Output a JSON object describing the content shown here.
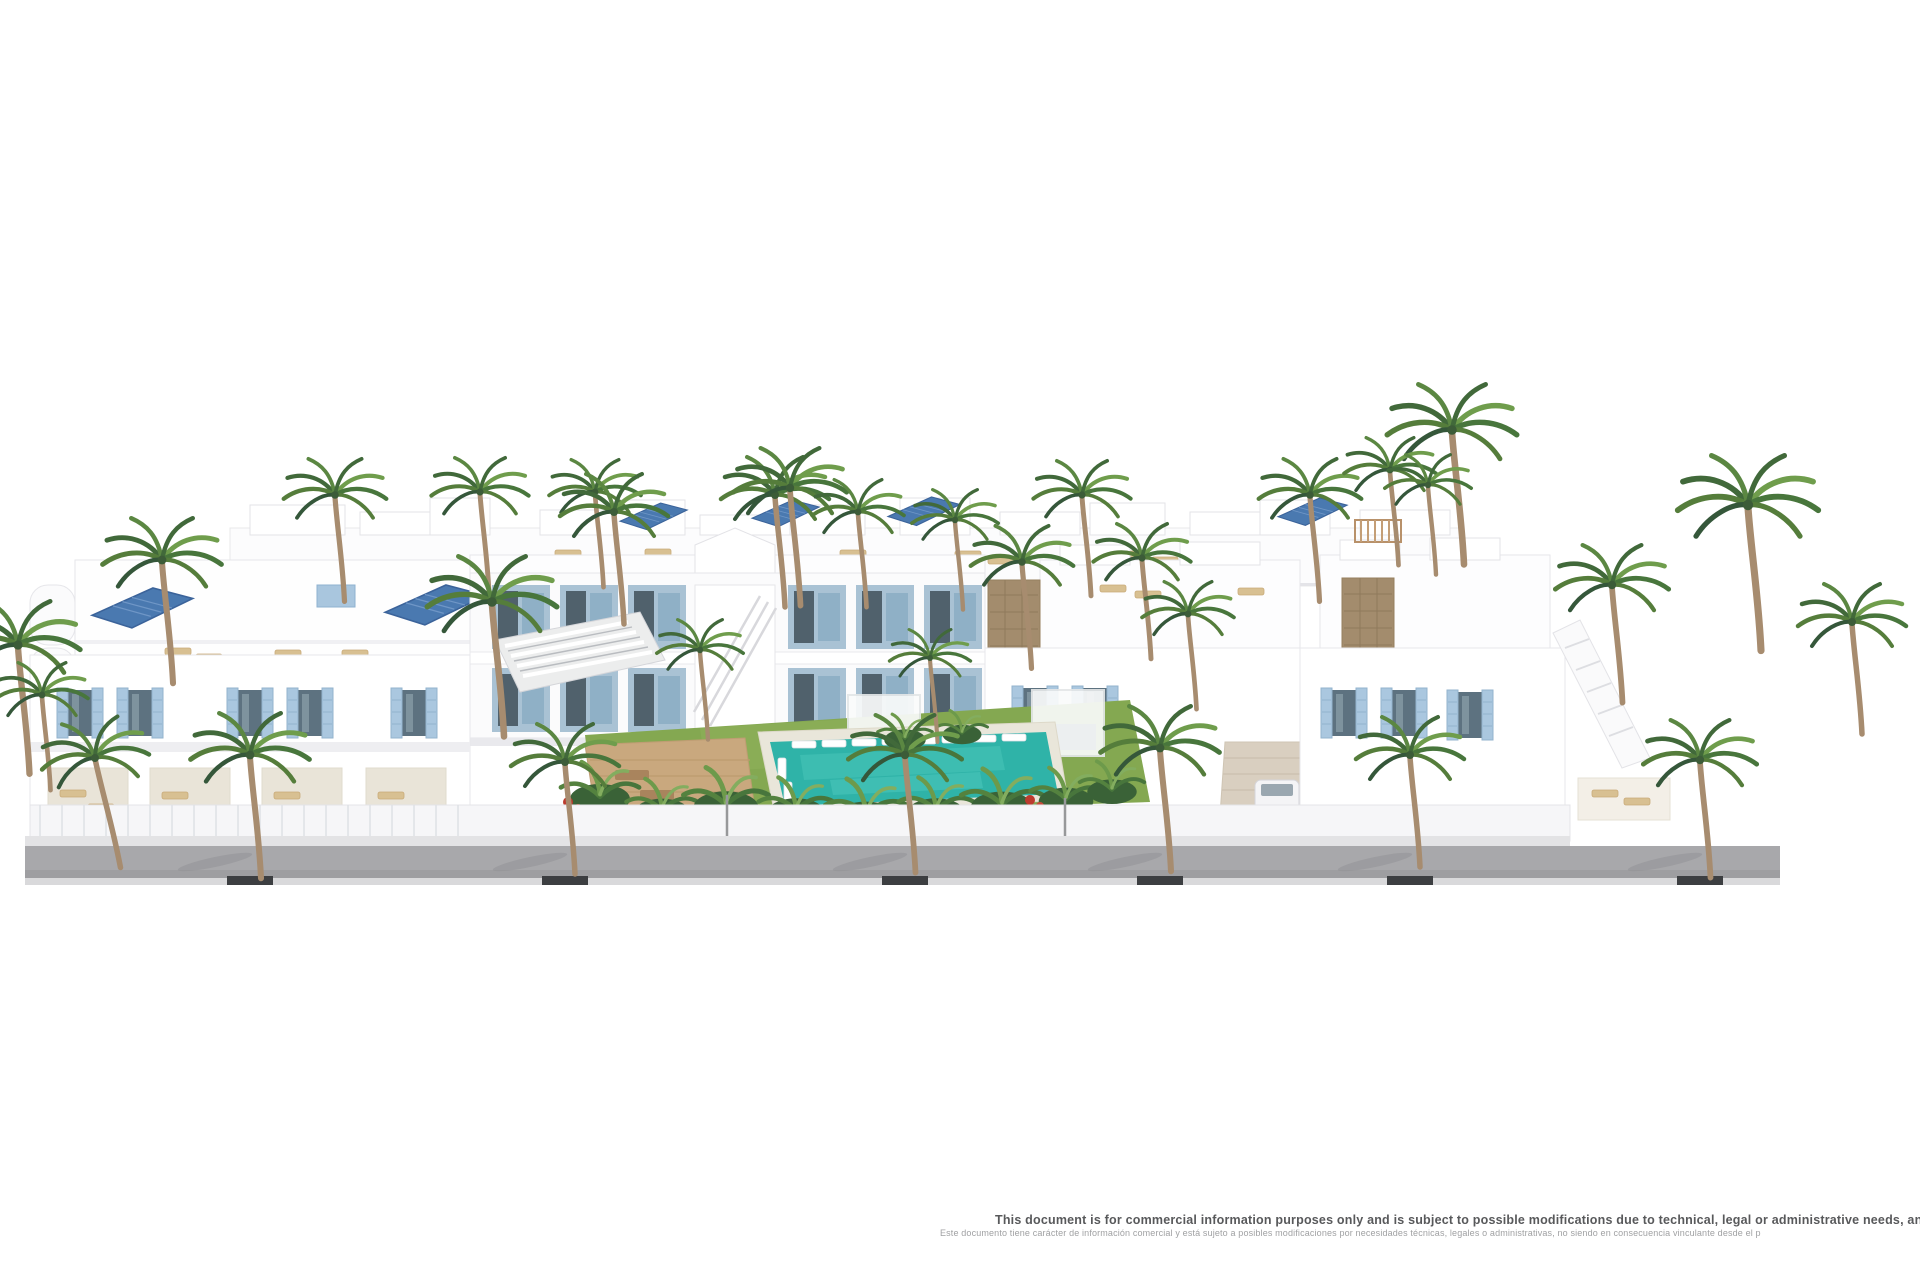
{
  "page": {
    "background": "#ffffff",
    "kind": "architectural-render-marketing-image"
  },
  "disclaimer": {
    "line1_en": "This document is for commercial information purposes only and is subject to possible modifications due to technical, legal or administrative needs, and is therefore no",
    "line2_es": "Este documento tiene carácter de información comercial y está sujeto a posibles modificaciones por necesidades técnicas, legales o administrativas, no siendo en consecuencia vinculante desde el p"
  },
  "scene": {
    "description": "Aerial 3D render of a white Mediterranean residential complex: rows of two-storey townhouses and villas with light-blue shutters, rooftop terraces with sun loungers and solar panels, a central communal garden with lawn, slatted pergola, wooden sun deck, teal swimming pool with white loungers, tropical planting and many palm trees, fronted by a grey street with palm trees in tree pits",
    "colors": {
      "building_white": "#ffffff",
      "building_shadow": "#ececef",
      "shutter_blue": "#aac7df",
      "window_glass": "#5d7280",
      "solar_panel_blue": "#4a79b0",
      "pool_water_teal": "#2fb3a8",
      "lawn_green": "#84a851",
      "palm_green": "#557d3b",
      "deck_wood": "#c9a87e",
      "stone_wall": "#a38c6d",
      "road_grey": "#a8a8ab",
      "tree_pit_dark": "#3c3e41",
      "disclaimer_text_en": "#58595b",
      "disclaimer_text_es": "#a0a1a3"
    }
  }
}
